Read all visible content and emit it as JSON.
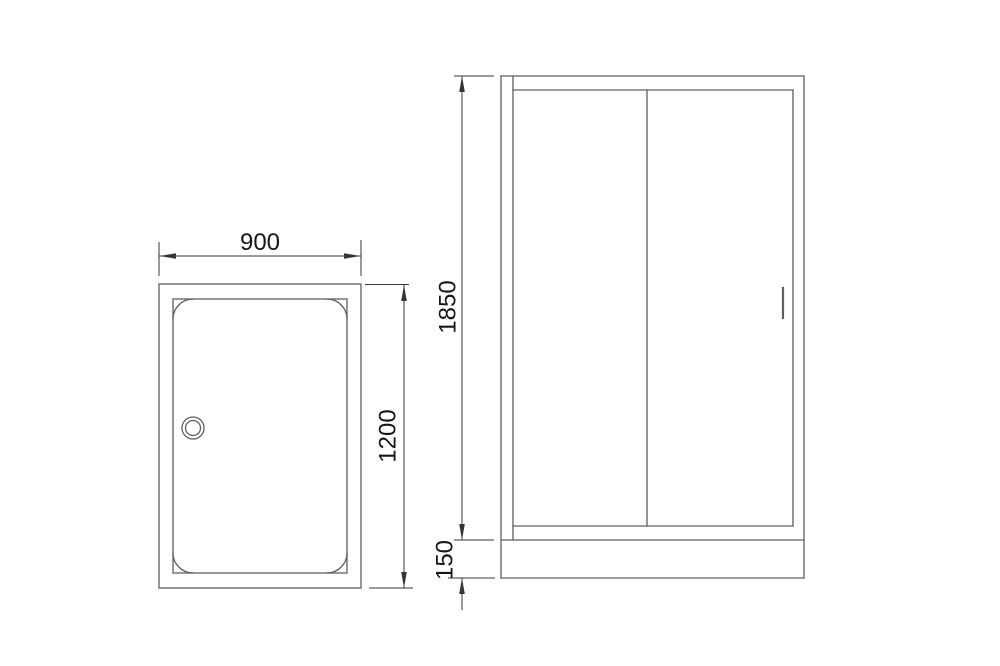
{
  "colors": {
    "background": "#ffffff",
    "object_line": "#5f5f5f",
    "dimension_line": "#353535",
    "text": "#161616"
  },
  "top_view": {
    "width": "900",
    "depth": "1200"
  },
  "front_view": {
    "door_height": "1850",
    "tray_height": "150"
  }
}
